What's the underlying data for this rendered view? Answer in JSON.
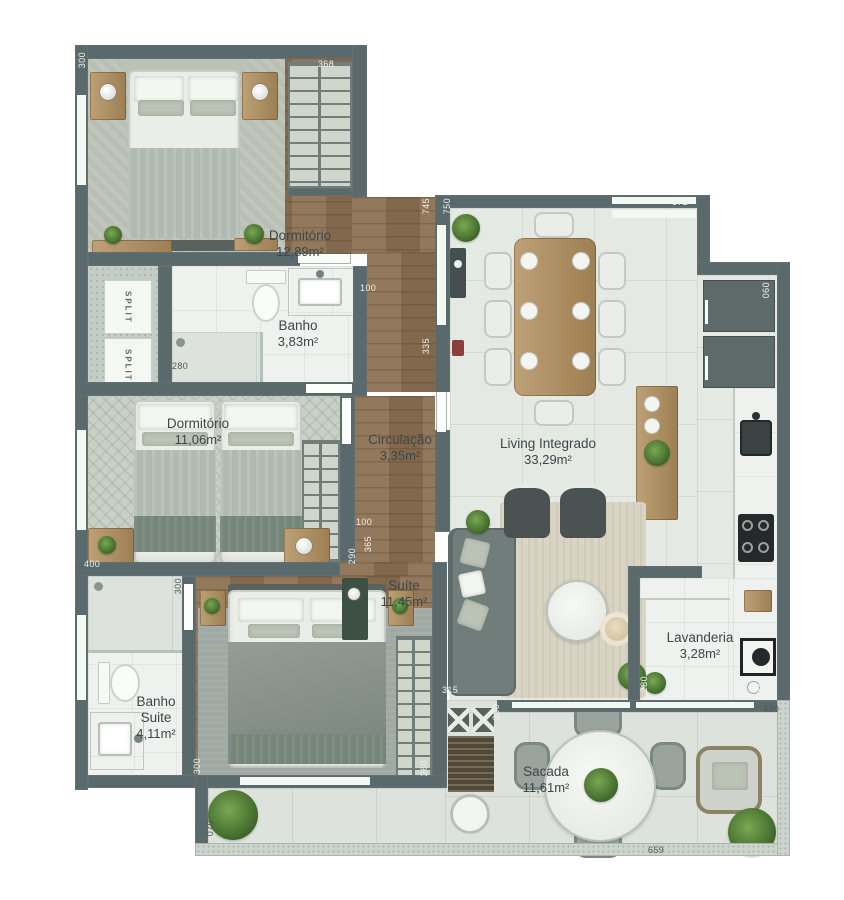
{
  "rooms": [
    {
      "name": "Dormitório",
      "area": "12,89m²",
      "x": 300,
      "y": 228
    },
    {
      "name": "Banho",
      "area": "3,83m²",
      "x": 298,
      "y": 318
    },
    {
      "name": "Dormitório",
      "area": "11,06m²",
      "x": 198,
      "y": 416
    },
    {
      "name": "Circulação",
      "area": "3,35m²",
      "x": 400,
      "y": 432
    },
    {
      "name": "Suíte",
      "area": "11,45m²",
      "x": 404,
      "y": 578
    },
    {
      "name": "Banho\nSuite",
      "area": "4,11m²",
      "x": 156,
      "y": 694
    },
    {
      "name": "Living Integrado",
      "area": "33,29m²",
      "x": 548,
      "y": 436
    },
    {
      "name": "Lavanderia",
      "area": "3,28m²",
      "x": 700,
      "y": 630
    },
    {
      "name": "Sacada",
      "area": "11,61m²",
      "x": 546,
      "y": 764
    }
  ],
  "dimensions": [
    {
      "v": "300",
      "x": 78,
      "y": 52,
      "r": 1,
      "t": "lt"
    },
    {
      "v": "368",
      "x": 318,
      "y": 60,
      "r": 0,
      "t": "lt"
    },
    {
      "v": "372",
      "x": 672,
      "y": 198,
      "r": 0,
      "t": "lt"
    },
    {
      "v": "745",
      "x": 422,
      "y": 198,
      "r": 1,
      "t": "lt"
    },
    {
      "v": "750",
      "x": 443,
      "y": 198,
      "r": 1,
      "t": "lt"
    },
    {
      "v": "335",
      "x": 422,
      "y": 338,
      "r": 1,
      "t": "lt"
    },
    {
      "v": "100",
      "x": 360,
      "y": 284,
      "r": 0,
      "t": "lt"
    },
    {
      "v": "280",
      "x": 172,
      "y": 362,
      "r": 0,
      "t": "dk"
    },
    {
      "v": "060",
      "x": 762,
      "y": 282,
      "r": 1,
      "t": "lt"
    },
    {
      "v": "400",
      "x": 84,
      "y": 560,
      "r": 0,
      "t": "lt"
    },
    {
      "v": "300",
      "x": 174,
      "y": 578,
      "r": 1,
      "t": "dk"
    },
    {
      "v": "100",
      "x": 356,
      "y": 518,
      "r": 0,
      "t": "lt"
    },
    {
      "v": "365",
      "x": 364,
      "y": 536,
      "r": 1,
      "t": "lt"
    },
    {
      "v": "290",
      "x": 348,
      "y": 548,
      "r": 1,
      "t": "lt"
    },
    {
      "v": "140",
      "x": 162,
      "y": 764,
      "r": 0,
      "t": "lt"
    },
    {
      "v": "300",
      "x": 193,
      "y": 758,
      "r": 1,
      "t": "lt"
    },
    {
      "v": "315",
      "x": 442,
      "y": 686,
      "r": 0,
      "t": "lt"
    },
    {
      "v": "200",
      "x": 492,
      "y": 704,
      "r": 1,
      "t": "lt"
    },
    {
      "v": "260",
      "x": 420,
      "y": 760,
      "r": 1,
      "t": "lt"
    },
    {
      "v": "280",
      "x": 640,
      "y": 676,
      "r": 1,
      "t": "lt"
    },
    {
      "v": "090",
      "x": 758,
      "y": 682,
      "r": 1,
      "t": "lt"
    },
    {
      "v": "430",
      "x": 763,
      "y": 705,
      "r": 0,
      "t": "dk"
    },
    {
      "v": "659",
      "x": 648,
      "y": 846,
      "r": 0,
      "t": "dk"
    },
    {
      "v": "070",
      "x": 206,
      "y": 820,
      "r": 1,
      "t": "dk"
    }
  ],
  "hvac": {
    "units": [
      "SPLIT",
      "SPLIT"
    ]
  },
  "colors": {
    "wall": "#5a696b",
    "wood_floor": "#8b7052",
    "living_tile": "#e5e9e4",
    "balcony_tile": "#dde3dc",
    "marble": "#eef1ed",
    "plant": "#4f7d38",
    "label_text": "#3e4649"
  }
}
